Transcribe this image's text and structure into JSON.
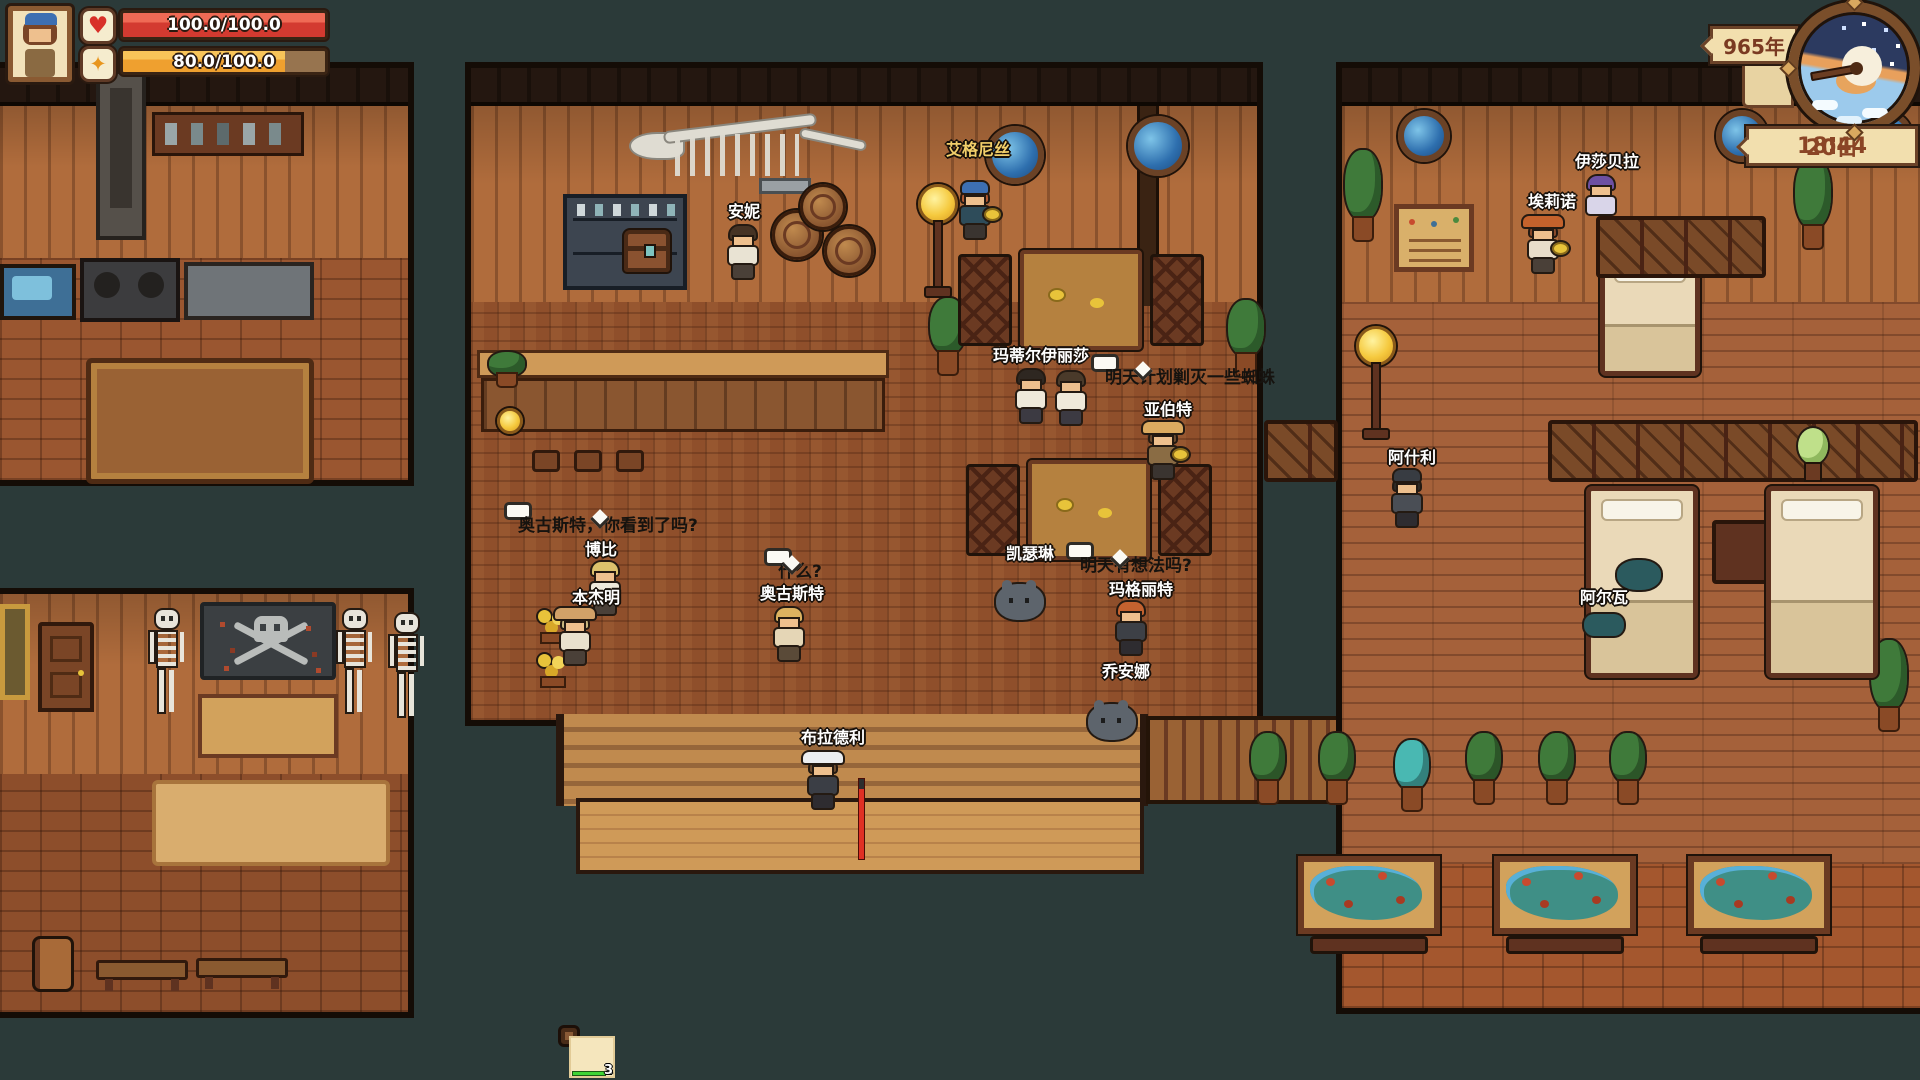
{
  "hud": {
    "health": {
      "label": "100.0/100.0",
      "percent": 100
    },
    "energy": {
      "label": "80.0/100.0",
      "percent": 80
    },
    "clock": {
      "year": "965年",
      "date": "20日",
      "time": "18:44"
    }
  },
  "colors": {
    "selection": "#8ce0d6",
    "health": "#d33a30",
    "energy": "#efa02f",
    "bubble_bg": "#fbfaf4",
    "name_label": "#ffffff",
    "name_label_gold": "#f2cf6a"
  },
  "world": {
    "npcs": [
      {
        "id": "annie",
        "name": "安妮",
        "label_x": 744,
        "label_y": 198,
        "x": 726,
        "y": 226,
        "kind": "person",
        "hair": "#463324",
        "skin": "#eec08e",
        "top": "#e9e3d3",
        "legs": "#4a4038"
      },
      {
        "id": "agnes",
        "name": "艾格尼丝",
        "label_x": 978,
        "label_y": 136,
        "x": 958,
        "y": 182,
        "kind": "person",
        "name_color": "#f2cf6a",
        "hat": "#3d6fb2",
        "hair": "#b05830",
        "skin": "#eec08e",
        "top": "#2e4c5a",
        "legs": "#3a3430",
        "plate": true
      },
      {
        "id": "matilda-elisa",
        "name": "玛蒂尔伊丽莎",
        "label_x": 1041,
        "label_y": 342,
        "x": 1014,
        "y": 370,
        "kind": "person",
        "hair": "#2e2721",
        "skin": "#eec08e",
        "top": "#efe9da",
        "legs": "#3c3a42"
      },
      {
        "id": "matilda-companion",
        "name": "",
        "label_x": 1074,
        "label_y": 342,
        "x": 1054,
        "y": 372,
        "kind": "person",
        "hair": "#4a3a2a",
        "skin": "#eec08e",
        "top": "#efe9da",
        "legs": "#3c3a42"
      },
      {
        "id": "albert",
        "name": "亚伯特",
        "label_x": 1168,
        "label_y": 396,
        "x": 1146,
        "y": 422,
        "kind": "person",
        "hat": "#dcab60",
        "wide_hat": true,
        "hair": "#6b4a2e",
        "skin": "#eec08e",
        "top": "#8a6c44",
        "legs": "#3a3430",
        "plate": true
      },
      {
        "id": "kathleen",
        "name": "凯瑟琳",
        "label_x": 1030,
        "label_y": 540,
        "x": 1002,
        "y": 566,
        "kind": "creature",
        "body": "#5d646c"
      },
      {
        "id": "margaret",
        "name": "玛格丽特",
        "label_x": 1141,
        "label_y": 576,
        "x": 1114,
        "y": 602,
        "kind": "person",
        "hair": "#c4622f",
        "skin": "#eec08e",
        "top": "#3d4046",
        "legs": "#2e2c30"
      },
      {
        "id": "joanna",
        "name": "乔安娜",
        "label_x": 1126,
        "label_y": 658,
        "x": 1094,
        "y": 686,
        "kind": "creature",
        "body": "#5d646c"
      },
      {
        "id": "august",
        "name": "奥古斯特",
        "label_x": 792,
        "label_y": 580,
        "x": 772,
        "y": 608,
        "kind": "person",
        "hair": "#dcb260",
        "skin": "#eec08e",
        "top": "#e5d6b6",
        "legs": "#5a4a38"
      },
      {
        "id": "bobby",
        "name": "博比",
        "label_x": 601,
        "label_y": 536,
        "x": 588,
        "y": 562,
        "kind": "person",
        "hair": "#dcc26c",
        "skin": "#eec08e",
        "top": "#efe9da",
        "legs": "#4a4038"
      },
      {
        "id": "benjamin",
        "name": "本杰明",
        "label_x": 596,
        "label_y": 584,
        "x": 558,
        "y": 608,
        "kind": "person",
        "hat": "#d2a268",
        "wide_hat": true,
        "hair": "#c9b77e",
        "skin": "#eec08e",
        "top": "#e9e1cd",
        "legs": "#4a4038"
      },
      {
        "id": "bradley",
        "name": "布拉德利",
        "label_x": 833,
        "label_y": 724,
        "x": 806,
        "y": 752,
        "kind": "person",
        "hat": "#eceef0",
        "wide_hat": true,
        "hair": "#6b4a2e",
        "skin": "#eec08e",
        "top": "#3b3e45",
        "legs": "#2e2c30"
      },
      {
        "id": "ashley",
        "name": "阿什利",
        "label_x": 1412,
        "label_y": 444,
        "x": 1390,
        "y": 470,
        "kind": "person",
        "hat": "#383c42",
        "hair": "#2e2a26",
        "skin": "#eec08e",
        "top": "#4a4e55",
        "legs": "#2e2c30"
      },
      {
        "id": "alva",
        "name": "阿尔瓦",
        "label_x": 1604,
        "label_y": 584,
        "x": 1584,
        "y": 610,
        "kind": "sleeper",
        "body": "#2b5a5e"
      },
      {
        "id": "isabella",
        "name": "伊莎贝拉",
        "label_x": 1607,
        "label_y": 148,
        "x": 1584,
        "y": 176,
        "kind": "sitter",
        "hair": "#6d50a2",
        "skin": "#eec08e",
        "top": "#d9d5e9",
        "legs": "#3c3a42"
      },
      {
        "id": "elinor",
        "name": "埃莉诺",
        "label_x": 1552,
        "label_y": 188,
        "x": 1526,
        "y": 216,
        "kind": "person",
        "hat": "#c4622c",
        "wide_hat": true,
        "hair": "#8a4a2a",
        "skin": "#eec08e",
        "top": "#e9ddc9",
        "legs": "#4a4038",
        "plate": true
      }
    ],
    "bubbles": [
      {
        "id": "bubble-spider",
        "text": "明天计划剿灭一些蜘蛛",
        "x": 1091,
        "y": 354,
        "tail": 42
      },
      {
        "id": "bubble-august-question",
        "text": "奥古斯特，你看到了吗?",
        "x": 504,
        "y": 502,
        "tail": 86
      },
      {
        "id": "bubble-what",
        "text": "什么?",
        "x": 764,
        "y": 548,
        "tail": 18
      },
      {
        "id": "bubble-tomorrow",
        "text": "明天有想法吗?",
        "x": 1066,
        "y": 542,
        "tail": 44
      }
    ],
    "player_marker": {
      "x": 858,
      "y": 778
    }
  },
  "hotbar": {
    "slot_count": 16,
    "selected_slot": 1,
    "items": [
      {
        "slot": 12,
        "icon": "box-item",
        "count": "3"
      },
      {
        "slot": 13,
        "icon": "potion-item",
        "count": "1"
      },
      {
        "slot": 14,
        "icon": "hammer-item",
        "count": "3",
        "durability_percent": 90
      }
    ]
  },
  "decor": {
    "portholes": [
      [
        1398,
        110,
        52
      ],
      [
        1716,
        110,
        52
      ],
      [
        1866,
        112,
        46
      ],
      [
        986,
        126,
        58
      ],
      [
        1128,
        116,
        60
      ]
    ],
    "plants": [
      [
        930,
        298,
        0
      ],
      [
        1228,
        300,
        0
      ],
      [
        1345,
        150,
        1
      ],
      [
        1795,
        158,
        1
      ],
      [
        1871,
        640,
        1
      ],
      [
        489,
        352,
        2
      ]
    ],
    "deck_plants": [
      [
        1251,
        733,
        0
      ],
      [
        1320,
        733,
        0
      ],
      [
        1467,
        733,
        0
      ],
      [
        1540,
        733,
        0
      ],
      [
        1611,
        733,
        0
      ],
      [
        1395,
        740,
        1
      ]
    ],
    "skeletons": [
      [
        148,
        610
      ],
      [
        336,
        610
      ],
      [
        388,
        614
      ]
    ],
    "stools": [
      [
        532,
        450
      ],
      [
        574,
        450
      ],
      [
        616,
        450
      ]
    ],
    "fish_tables": [
      [
        1298,
        856
      ],
      [
        1494,
        856
      ],
      [
        1688,
        856
      ]
    ],
    "barrels": [
      [
        772,
        210,
        50
      ],
      [
        800,
        184,
        46
      ],
      [
        824,
        226,
        50
      ]
    ],
    "benches": [
      [
        96,
        960,
        92
      ],
      [
        196,
        958,
        92
      ]
    ],
    "lamps": [
      [
        918,
        184,
        0
      ],
      [
        1356,
        326,
        0
      ],
      [
        497,
        408,
        1
      ]
    ],
    "table_sets": [
      [
        958,
        250
      ],
      [
        966,
        460
      ]
    ],
    "beds": [
      [
        1600,
        248,
        100,
        128,
        0
      ],
      [
        1586,
        486,
        112,
        192,
        1
      ],
      [
        1766,
        486,
        112,
        192,
        0
      ]
    ],
    "bench_rows": [
      [
        1548,
        420,
        370
      ],
      [
        1264,
        420,
        74
      ],
      [
        1596,
        216,
        170
      ]
    ],
    "flowers": [
      [
        534,
        610
      ],
      [
        534,
        654
      ]
    ],
    "egg_plant": [
      1794,
      428
    ],
    "chest": [
      624,
      230
    ],
    "barrel_left": [
      32,
      936
    ]
  }
}
